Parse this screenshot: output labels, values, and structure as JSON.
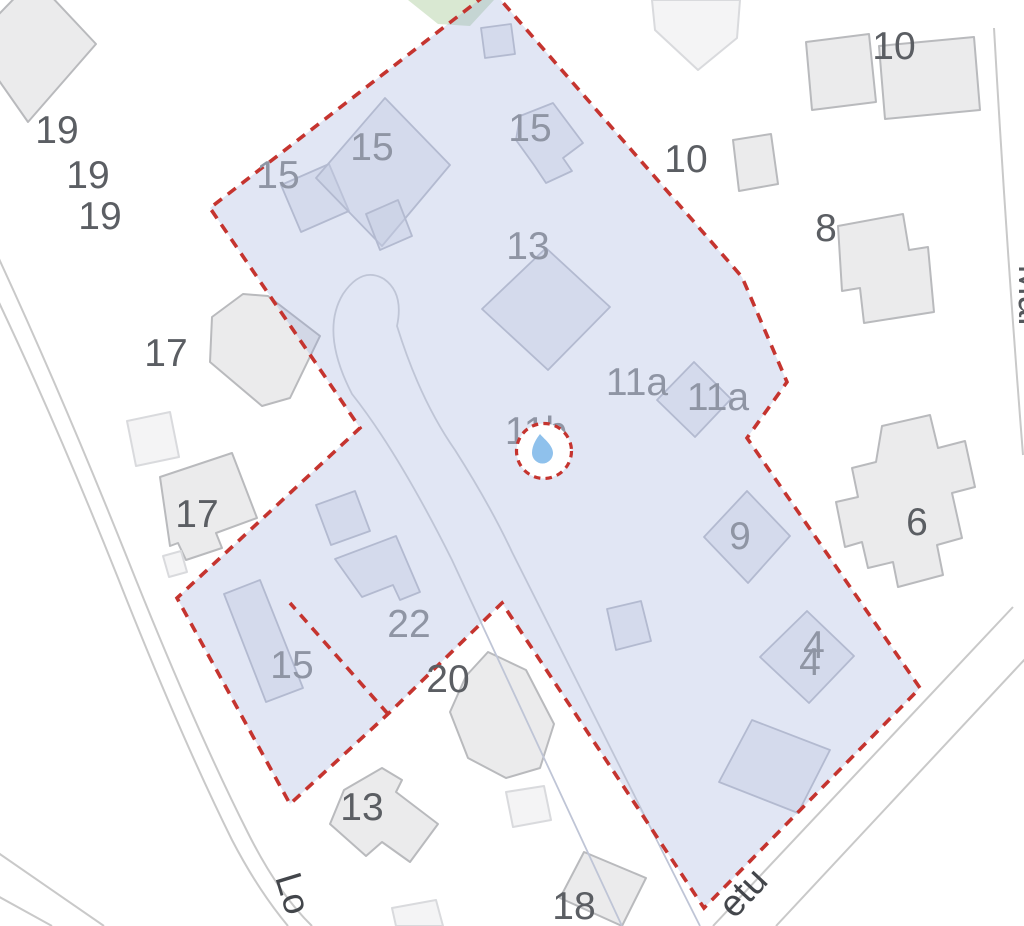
{
  "title": "Cadastral map with selected parcel",
  "colors": {
    "background": "#ffffff",
    "parcel_fill": "#8fa2d8",
    "parcel_fill_opacity": 0.27,
    "parcel_border_red": "#c5342f",
    "building_fill": "#ebebec",
    "building_stroke": "#b9babd",
    "building_light_fill": "#f4f4f5",
    "building_light_stroke": "#d9dadd",
    "inside_building_fill": "#c6cde2",
    "inside_building_stroke": "#b3bad0",
    "road_stroke": "#c9c9c9",
    "driveway_stroke": "#bfc5d6",
    "green_area_fill": "#d9e8d2",
    "marker_droplet": "#8fc1ec",
    "marker_circle_fill": "#ffffff"
  },
  "marker": {
    "icon": "water-droplet-icon",
    "cx": 544,
    "cy": 451,
    "radius": 27.5,
    "dash": "6.5 5.2"
  },
  "labels": {
    "outside": [
      {
        "text": "19",
        "x": 57,
        "y": 143
      },
      {
        "text": "19",
        "x": 88,
        "y": 188
      },
      {
        "text": "19",
        "x": 100,
        "y": 229
      },
      {
        "text": "17",
        "x": 166,
        "y": 366
      },
      {
        "text": "17",
        "x": 197,
        "y": 527
      },
      {
        "text": "10",
        "x": 686,
        "y": 172
      },
      {
        "text": "10",
        "x": 894,
        "y": 59
      },
      {
        "text": "8",
        "x": 826,
        "y": 241
      },
      {
        "text": "6",
        "x": 917,
        "y": 535
      },
      {
        "text": "20",
        "x": 448,
        "y": 692
      },
      {
        "text": "13",
        "x": 362,
        "y": 820
      },
      {
        "text": "18",
        "x": 574,
        "y": 919
      }
    ],
    "inside": [
      {
        "text": "15",
        "x": 278,
        "y": 188
      },
      {
        "text": "15",
        "x": 372,
        "y": 160
      },
      {
        "text": "15",
        "x": 530,
        "y": 141
      },
      {
        "text": "13",
        "x": 528,
        "y": 259
      },
      {
        "text": "11a",
        "x": 637,
        "y": 395
      },
      {
        "text": "11a",
        "x": 718,
        "y": 410
      },
      {
        "text": "11b",
        "x": 536,
        "y": 444
      },
      {
        "text": "22",
        "x": 409,
        "y": 637
      },
      {
        "text": "15",
        "x": 292,
        "y": 678
      },
      {
        "text": "9",
        "x": 740,
        "y": 549
      },
      {
        "text": "4",
        "x": 814,
        "y": 658
      },
      {
        "text": "4",
        "x": 810,
        "y": 675
      }
    ],
    "streets": [
      {
        "text": "Lo",
        "x": 281,
        "y": 897,
        "rotation": 73,
        "class": "lbl-street"
      },
      {
        "text": "etu",
        "x": 752,
        "y": 901,
        "rotation": -47,
        "class": "lbl-street"
      },
      {
        "text": "Mal",
        "x": 1019,
        "y": 295,
        "rotation": 90,
        "class": "lbl-street-right"
      }
    ]
  },
  "parcel": {
    "outline": [
      [
        492,
        -10
      ],
      [
        742,
        277
      ],
      [
        787,
        382
      ],
      [
        747,
        438
      ],
      [
        920,
        688
      ],
      [
        704,
        908
      ],
      [
        502,
        603
      ],
      [
        388,
        714
      ],
      [
        290,
        804
      ],
      [
        177,
        598
      ],
      [
        360,
        428
      ],
      [
        210,
        208
      ]
    ],
    "slit": [
      [
        388,
        714
      ],
      [
        290,
        603
      ]
    ],
    "dash": "10 7.5",
    "stroke_width": 3.6
  },
  "geometry": {
    "roads": [
      "M -6 248 Q 60 390 128 560 Q 195 728 248 833 Q 278 893 312 926",
      "M -6 292 Q 55 420 118 578 Q 180 735 232 840 Q 258 890 288 926",
      "M -6 850 L 104 926",
      "M -6 894 L 52 926",
      "M 994 28 Q 1006 240 1023 455",
      "M 1013 607 L 713 926",
      "M 1026 658 L 776 926"
    ],
    "driveway": "M 622 926 L 452 560 Q 398 452 352 394 Q 320 332 343 294 Q 362 266 384 279 Q 404 293 397 326 Q 420 400 455 450 Q 490 505 512 552 L 700 926",
    "green_area": [
      [
        408,
        0
      ],
      [
        494,
        0
      ],
      [
        470,
        26
      ],
      [
        438,
        24
      ]
    ],
    "buildings_outside": [
      {
        "pts": [
          [
            -28,
            42
          ],
          [
            34,
            -22
          ],
          [
            96,
            44
          ],
          [
            28,
            122
          ]
        ],
        "light": false
      },
      {
        "pts": [
          [
            652,
            0
          ],
          [
            740,
            0
          ],
          [
            737,
            38
          ],
          [
            698,
            70
          ],
          [
            655,
            30
          ]
        ],
        "light": true
      },
      {
        "pts": [
          [
            806,
            42
          ],
          [
            869,
            34
          ],
          [
            876,
            102
          ],
          [
            812,
            110
          ]
        ],
        "light": false
      },
      {
        "pts": [
          [
            879,
            46
          ],
          [
            974,
            37
          ],
          [
            980,
            110
          ],
          [
            885,
            119
          ]
        ],
        "light": false
      },
      {
        "pts": [
          [
            733,
            140
          ],
          [
            771,
            134
          ],
          [
            778,
            184
          ],
          [
            739,
            191
          ]
        ],
        "light": false
      },
      {
        "pts": [
          [
            838,
            226
          ],
          [
            903,
            214
          ],
          [
            909,
            250
          ],
          [
            928,
            247
          ],
          [
            934,
            312
          ],
          [
            864,
            323
          ],
          [
            860,
            288
          ],
          [
            842,
            291
          ]
        ],
        "light": false
      },
      {
        "pts": [
          [
            212,
            317
          ],
          [
            243,
            294
          ],
          [
            268,
            296
          ],
          [
            320,
            336
          ],
          [
            290,
            398
          ],
          [
            262,
            406
          ],
          [
            210,
            362
          ]
        ],
        "light": false
      },
      {
        "pts": [
          [
            127,
            421
          ],
          [
            170,
            412
          ],
          [
            179,
            457
          ],
          [
            136,
            466
          ]
        ],
        "light": true
      },
      {
        "pts": [
          [
            160,
            477
          ],
          [
            232,
            453
          ],
          [
            257,
            518
          ],
          [
            216,
            533
          ],
          [
            222,
            548
          ],
          [
            186,
            560
          ],
          [
            178,
            543
          ],
          [
            170,
            546
          ]
        ],
        "light": false
      },
      {
        "pts": [
          [
            163,
            556
          ],
          [
            181,
            551
          ],
          [
            187,
            572
          ],
          [
            169,
            577
          ]
        ],
        "light": true
      },
      {
        "pts": [
          [
            882,
            426
          ],
          [
            930,
            415
          ],
          [
            938,
            448
          ],
          [
            965,
            441
          ],
          [
            975,
            487
          ],
          [
            952,
            493
          ],
          [
            962,
            538
          ],
          [
            937,
            545
          ],
          [
            943,
            575
          ],
          [
            898,
            587
          ],
          [
            893,
            562
          ],
          [
            868,
            568
          ],
          [
            862,
            542
          ],
          [
            845,
            547
          ],
          [
            836,
            502
          ],
          [
            858,
            497
          ],
          [
            852,
            468
          ],
          [
            876,
            462
          ]
        ],
        "light": false
      },
      {
        "pts": [
          [
            488,
            652
          ],
          [
            526,
            670
          ],
          [
            554,
            724
          ],
          [
            540,
            768
          ],
          [
            506,
            778
          ],
          [
            468,
            758
          ],
          [
            450,
            712
          ],
          [
            466,
            676
          ]
        ],
        "light": false
      },
      {
        "pts": [
          [
            344,
            790
          ],
          [
            382,
            768
          ],
          [
            402,
            780
          ],
          [
            396,
            792
          ],
          [
            438,
            824
          ],
          [
            410,
            862
          ],
          [
            382,
            842
          ],
          [
            366,
            856
          ],
          [
            330,
            824
          ]
        ],
        "light": false
      },
      {
        "pts": [
          [
            584,
            852
          ],
          [
            646,
            878
          ],
          [
            622,
            926
          ],
          [
            560,
            898
          ]
        ],
        "light": false
      },
      {
        "pts": [
          [
            506,
            792
          ],
          [
            544,
            786
          ],
          [
            551,
            820
          ],
          [
            513,
            827
          ]
        ],
        "light": true
      },
      {
        "pts": [
          [
            392,
            908
          ],
          [
            436,
            900
          ],
          [
            443,
            926
          ],
          [
            396,
            926
          ]
        ],
        "light": true
      }
    ],
    "buildings_inside": [
      {
        "pts": [
          [
            481,
            28
          ],
          [
            511,
            24
          ],
          [
            515,
            54
          ],
          [
            485,
            58
          ]
        ]
      },
      {
        "pts": [
          [
            281,
            185
          ],
          [
            329,
            164
          ],
          [
            349,
            211
          ],
          [
            301,
            232
          ]
        ]
      },
      {
        "pts": [
          [
            385,
            98
          ],
          [
            450,
            165
          ],
          [
            382,
            246
          ],
          [
            316,
            178
          ]
        ]
      },
      {
        "pts": [
          [
            366,
            214
          ],
          [
            398,
            200
          ],
          [
            412,
            236
          ],
          [
            380,
            250
          ]
        ]
      },
      {
        "pts": [
          [
            520,
            116
          ],
          [
            553,
            103
          ],
          [
            583,
            143
          ],
          [
            563,
            158
          ],
          [
            572,
            171
          ],
          [
            546,
            183
          ],
          [
            534,
            165
          ],
          [
            516,
            140
          ]
        ]
      },
      {
        "pts": [
          [
            546,
            248
          ],
          [
            610,
            307
          ],
          [
            548,
            370
          ],
          [
            482,
            309
          ]
        ]
      },
      {
        "pts": [
          [
            694,
            362
          ],
          [
            731,
            399
          ],
          [
            695,
            437
          ],
          [
            657,
            400
          ]
        ]
      },
      {
        "pts": [
          [
            747,
            491
          ],
          [
            790,
            536
          ],
          [
            748,
            583
          ],
          [
            704,
            537
          ]
        ]
      },
      {
        "pts": [
          [
            807,
            611
          ],
          [
            854,
            656
          ],
          [
            809,
            703
          ],
          [
            760,
            657
          ]
        ]
      },
      {
        "pts": [
          [
            752,
            720
          ],
          [
            830,
            750
          ],
          [
            798,
            813
          ],
          [
            719,
            782
          ]
        ]
      },
      {
        "pts": [
          [
            607,
            609
          ],
          [
            641,
            601
          ],
          [
            651,
            641
          ],
          [
            616,
            650
          ]
        ]
      },
      {
        "pts": [
          [
            316,
            505
          ],
          [
            355,
            491
          ],
          [
            370,
            531
          ],
          [
            331,
            545
          ]
        ]
      },
      {
        "pts": [
          [
            335,
            559
          ],
          [
            396,
            536
          ],
          [
            420,
            592
          ],
          [
            400,
            600
          ],
          [
            393,
            585
          ],
          [
            362,
            597
          ]
        ]
      },
      {
        "pts": [
          [
            224,
            594
          ],
          [
            260,
            580
          ],
          [
            303,
            688
          ],
          [
            266,
            702
          ]
        ]
      }
    ]
  }
}
